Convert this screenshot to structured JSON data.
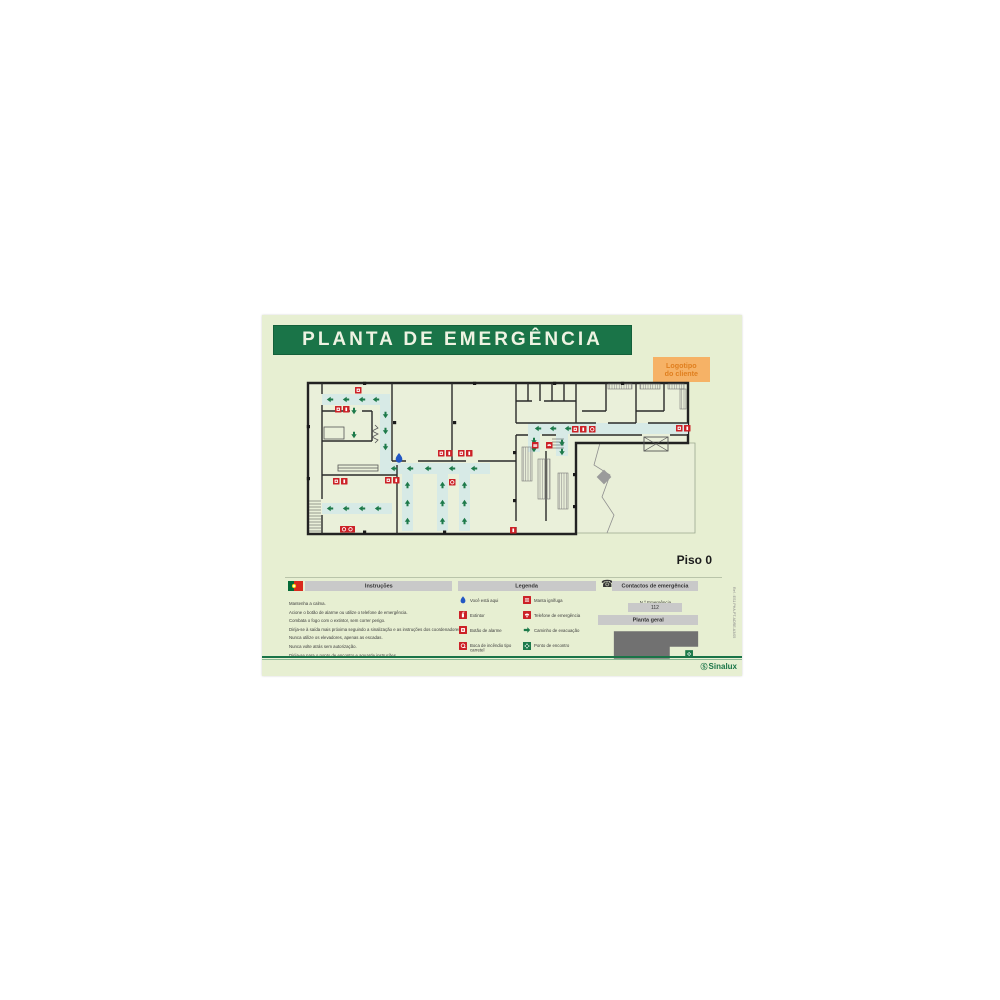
{
  "poster": {
    "title": "PLANTA DE EMERGÊNCIA",
    "logo_line1": "Logotipo",
    "logo_line2": "do cliente",
    "floor_label": "Piso 0",
    "brand_mark": "Ⓢ",
    "brand": "Sinalux",
    "side_ref": "Ref.: ES1 PHA-PT-ADRE-A3/05"
  },
  "instructions": {
    "title": "Instruções",
    "items": [
      "Mantenha a calma.",
      "Acione o botão de alarme ou utilize o telefone de emergência.",
      "Combata o fogo com o extintor, sem correr perigo.",
      "Dirija-se à saída mais próxima seguindo a sinalização e as instruções dos coordenadores.",
      "Nunca utilize os elevadores, apenas as escadas.",
      "Nunca volte atrás sem autorização.",
      "Dirija-se para o ponto de encontro e aguarde instruções."
    ]
  },
  "legend": {
    "title": "Legenda",
    "items_left": [
      {
        "icon": "you-are-here",
        "label": "Você está aqui"
      },
      {
        "icon": "extinguisher",
        "label": "Extintor"
      },
      {
        "icon": "alarm-button",
        "label": "Botão de alarme"
      },
      {
        "icon": "fire-hose-reel",
        "label": "Boca de incêndio tipo carretel"
      }
    ],
    "items_right": [
      {
        "icon": "fire-blanket",
        "label": "Manta ignífuga"
      },
      {
        "icon": "emergency-phone",
        "label": "Telefone de emergência"
      },
      {
        "icon": "evacuation-route",
        "label": "Caminho de evacuação"
      },
      {
        "icon": "meeting-point",
        "label": "Ponto de encontro"
      }
    ]
  },
  "contacts": {
    "title": "Contactos de emergência",
    "number_label": "N.º Emergência",
    "number": "112",
    "overview_title": "Planta geral"
  },
  "colors": {
    "header_green": "#1a7448",
    "poster_bg": "#e7efd2",
    "accent_red": "#cc2127",
    "route_fill": "#d7eae6",
    "arrow_green": "#1d7a4a",
    "drop_blue": "#2257c4",
    "bar_gray": "#c9c9c9",
    "map_gray": "#717171",
    "orange_bg": "#f6b266",
    "orange_text": "#e07f1f"
  },
  "floor_plan": {
    "routes": [
      {
        "x": 16,
        "y": 13,
        "w": 68,
        "h": 11
      },
      {
        "x": 74,
        "y": 24,
        "w": 11,
        "h": 58
      },
      {
        "x": 74,
        "y": 82,
        "w": 110,
        "h": 11
      },
      {
        "x": 96,
        "y": 93,
        "w": 11,
        "h": 57
      },
      {
        "x": 131,
        "y": 93,
        "w": 11,
        "h": 57
      },
      {
        "x": 153,
        "y": 93,
        "w": 11,
        "h": 57
      },
      {
        "x": 16,
        "y": 122,
        "w": 70,
        "h": 11
      },
      {
        "x": 222,
        "y": 42,
        "w": 160,
        "h": 11
      },
      {
        "x": 222,
        "y": 53,
        "w": 12,
        "h": 18
      },
      {
        "x": 250,
        "y": 53,
        "w": 12,
        "h": 22
      }
    ],
    "arrows": [
      [
        24,
        18.5,
        "left"
      ],
      [
        40,
        18.5,
        "left"
      ],
      [
        56,
        18.5,
        "left"
      ],
      [
        70,
        18.5,
        "left"
      ],
      [
        79.5,
        34,
        "down"
      ],
      [
        79.5,
        50,
        "down"
      ],
      [
        79.5,
        66,
        "down"
      ],
      [
        88,
        87.5,
        "left"
      ],
      [
        104,
        87.5,
        "left"
      ],
      [
        122,
        87.5,
        "left"
      ],
      [
        146,
        87.5,
        "left"
      ],
      [
        168,
        87.5,
        "left"
      ],
      [
        101.5,
        104,
        "up"
      ],
      [
        101.5,
        122,
        "up"
      ],
      [
        101.5,
        140,
        "up"
      ],
      [
        136.5,
        104,
        "up"
      ],
      [
        136.5,
        122,
        "up"
      ],
      [
        136.5,
        140,
        "up"
      ],
      [
        158.5,
        104,
        "up"
      ],
      [
        158.5,
        122,
        "up"
      ],
      [
        158.5,
        140,
        "up"
      ],
      [
        24,
        127.5,
        "left"
      ],
      [
        40,
        127.5,
        "left"
      ],
      [
        56,
        127.5,
        "left"
      ],
      [
        72,
        127.5,
        "left"
      ],
      [
        232,
        47.5,
        "left"
      ],
      [
        247,
        47.5,
        "left"
      ],
      [
        262,
        47.5,
        "left"
      ],
      [
        277,
        47.5,
        "left"
      ],
      [
        228,
        60,
        "down"
      ],
      [
        228,
        68,
        "down"
      ],
      [
        256,
        62,
        "down"
      ],
      [
        256,
        71,
        "down"
      ],
      [
        48,
        30,
        "down"
      ],
      [
        48,
        54,
        "down"
      ]
    ],
    "icons": [
      [
        49,
        6,
        "alarm"
      ],
      [
        29,
        25,
        "alarm"
      ],
      [
        37,
        25,
        "ext"
      ],
      [
        132,
        69,
        "alarm"
      ],
      [
        140,
        69,
        "ext"
      ],
      [
        152,
        69,
        "alarm"
      ],
      [
        160,
        69,
        "ext"
      ],
      [
        79,
        96,
        "alarm"
      ],
      [
        87,
        96,
        "ext"
      ],
      [
        143,
        98,
        "hose"
      ],
      [
        27,
        97,
        "alarm"
      ],
      [
        35,
        97,
        "ext"
      ],
      [
        204,
        146,
        "ext"
      ],
      [
        266,
        45,
        "alarm"
      ],
      [
        274,
        45,
        "ext"
      ],
      [
        283,
        45,
        "hose"
      ],
      [
        226,
        61,
        "blanket"
      ],
      [
        240,
        61,
        "phone"
      ],
      [
        370,
        44,
        "alarm"
      ],
      [
        378,
        44,
        "ext"
      ],
      [
        34,
        145,
        "wide"
      ]
    ],
    "you_are_here": {
      "x": 93,
      "y": 77
    }
  }
}
